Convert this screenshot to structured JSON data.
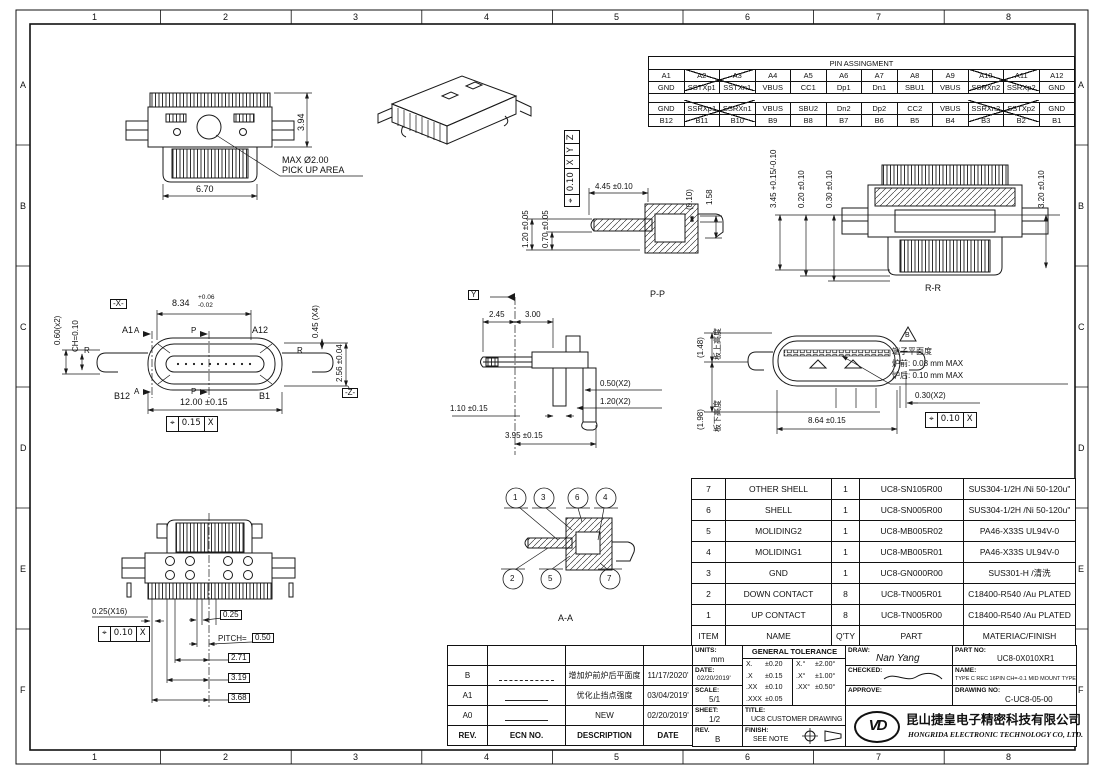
{
  "frame": {
    "cols": [
      "1",
      "2",
      "3",
      "4",
      "5",
      "6",
      "7",
      "8"
    ],
    "rows": [
      "A",
      "B",
      "C",
      "D",
      "E",
      "F"
    ]
  },
  "pin_table": {
    "title": "PIN ASSINGMENT",
    "a_pins": [
      "A1",
      "A2",
      "A3",
      "A4",
      "A5",
      "A6",
      "A7",
      "A8",
      "A9",
      "A10",
      "A11",
      "A12"
    ],
    "a_sigs": [
      "GND",
      "SSTXp1",
      "SSTXn1",
      "VBUS",
      "CC1",
      "Dp1",
      "Dn1",
      "SBU1",
      "VBUS",
      "SSRXn2",
      "SSRXp2",
      "GND"
    ],
    "b_sigs": [
      "GND",
      "SSRXp1",
      "SSRXn1",
      "VBUS",
      "SBU2",
      "Dn2",
      "Dp2",
      "CC2",
      "VBUS",
      "SSRXn2",
      "SSTXp2",
      "GND"
    ],
    "b_pins": [
      "B12",
      "B11",
      "B10",
      "B9",
      "B8",
      "B7",
      "B6",
      "B5",
      "B4",
      "B3",
      "B2",
      "B1"
    ]
  },
  "views": {
    "top": {
      "dim_h": "3.94",
      "dim_w": "6.70",
      "pickup1": "MAX Ø2.00",
      "pickup2": "PICK UP AREA"
    },
    "iso": {},
    "pp": {
      "label": "P-P",
      "d_120": "1.20 ±0.05",
      "d_070": "0.70 ±0.05",
      "fcf": [
        "⌖",
        "0.10",
        "X",
        "Y",
        "Z"
      ],
      "d_445": "4.45 ±0.10",
      "d_010": "(0.10)",
      "d_158": "1.58"
    },
    "rr": {
      "label": "R-R",
      "d_345": "3.45 +0.15/-0.10",
      "d_020": "0.20 ±0.10",
      "d_030": "0.30 ±0.10",
      "d_320": "3.20 ±0.10"
    },
    "front": {
      "a1": "A1",
      "a12": "A12",
      "b12": "B12",
      "b1": "B1",
      "r_left": "R",
      "r_right": "R",
      "sec_a": "A",
      "sec_p": "P",
      "datum_x": "-X-",
      "datum_z": "-Z-",
      "d_060": "0.60(x2)",
      "d_ch": "CH=0.10",
      "d_834": "8.34",
      "d_834_up": "+0.06",
      "d_834_dn": "-0.02",
      "d_045": "0.45 (X4)",
      "d_256": "2.56 ±0.04",
      "d_1200": "12.00 ±0.15",
      "fcf": [
        "⌖",
        "0.15",
        "X"
      ]
    },
    "side": {
      "datum_y": "Y",
      "d_245": "2.45",
      "d_300": "3.00",
      "d_050": "0.50(X2)",
      "d_120": "1.20(X2)",
      "d_110": "1.10 ±0.15",
      "d_395": "3.95 ±0.15"
    },
    "rear": {
      "d_148": "(1.48)",
      "lbl_148": "板上高度",
      "d_198": "(1.98)",
      "lbl_198": "板下高度",
      "d_864": "8.64 ±0.15",
      "d_030": "0.30(X2)",
      "fcf": [
        "⌖",
        "0.10",
        "X"
      ],
      "flag": "B",
      "note1": "端子平面度",
      "note2": "炉前: 0.08 mm MAX",
      "note3": "炉后: 0.10 mm MAX"
    },
    "bottom": {
      "d_025x16": "0.25(X16)",
      "fcf": [
        "⌖",
        "0.10",
        "X"
      ],
      "d_025": "0.25",
      "pitch_label": "PITCH=",
      "pitch": "0.50",
      "d_271": "2.71",
      "d_319": "3.19",
      "d_368": "3.68"
    },
    "aa": {
      "label": "A-A",
      "balloons_top": [
        "1",
        "3",
        "6",
        "4"
      ],
      "balloons_bottom": [
        "2",
        "5",
        "7"
      ]
    }
  },
  "bom": {
    "headers": [
      "ITEM",
      "NAME",
      "Q'TY",
      "PART",
      "MATERIAC/FINISH"
    ],
    "rows": [
      [
        "7",
        "OTHER SHELL",
        "1",
        "UC8-SN105R00",
        "SUS304-1/2H /Ni 50-120u\""
      ],
      [
        "6",
        "SHELL",
        "1",
        "UC8-SN005R00",
        "SUS304-1/2H /Ni 50-120u\""
      ],
      [
        "5",
        "MOLIDING2",
        "1",
        "UC8-MB005R02",
        "PA46-X33S UL94V-0"
      ],
      [
        "4",
        "MOLIDING1",
        "1",
        "UC8-MB005R01",
        "PA46-X33S UL94V-0"
      ],
      [
        "3",
        "GND",
        "1",
        "UC8-GN000R00",
        "SUS301-H /清洗"
      ],
      [
        "2",
        "DOWN CONTACT",
        "8",
        "UC8-TN005R01",
        "C18400-R540 /Au PLATED"
      ],
      [
        "1",
        "UP CONTACT",
        "8",
        "UC8-TN005R00",
        "C18400-R540 /Au PLATED"
      ]
    ]
  },
  "revisions": {
    "headers": [
      "REV.",
      "ECN NO.",
      "DESCRIPTION",
      "DATE"
    ],
    "rows": [
      [
        "B",
        "",
        "增加炉前炉后平面度",
        "11/17/2020'"
      ],
      [
        "A1",
        "",
        "优化止挡点强度",
        "03/04/2019'"
      ],
      [
        "A0",
        "",
        "NEW",
        "02/20/2019'"
      ]
    ]
  },
  "title_block": {
    "units_label": "UNITS:",
    "units": "mm",
    "date_label": "DATE:",
    "date": "02/20/2019'",
    "scale_label": "SCALE:",
    "scale": "5/1",
    "sheet_label": "SHEET:",
    "sheet": "1/2",
    "rev_label": "REV.",
    "rev": "B",
    "gt_title": "GENERAL TOLERANCE",
    "gt": [
      [
        "X.",
        "±0.20",
        "X.°",
        "±2.00°"
      ],
      [
        ".X",
        "±0.15",
        ".X°",
        "±1.00°"
      ],
      [
        ".XX",
        "±0.10",
        ".XX°",
        "±0.50°"
      ],
      [
        ".XXX",
        "±0.05",
        "",
        ""
      ]
    ],
    "title_label": "TITLE:",
    "title": "UC8 CUSTOMER DRAWING",
    "finish_label": "FINISH:",
    "finish": "SEE NOTE",
    "draw_label": "DRAW:",
    "draw": "Nan Yang",
    "checked_label": "CHECKED:",
    "approve_label": "APPROVE:",
    "part_no_label": "PART NO:",
    "part_no": "UC8-0X010XR1",
    "name_label": "NAME:",
    "name": "TYPE C REC 16PIN CH=-0.1 MID MOUNT TYPE",
    "drawing_no_label": "DRAWING NO:",
    "drawing_no": "C-UC8-05-00",
    "logo": "VD",
    "company_cn": "昆山捷皇电子精密科技有限公司",
    "company_en": "HONGRIDA ELECTRONIC TECHNOLOGY CO, LTD."
  }
}
